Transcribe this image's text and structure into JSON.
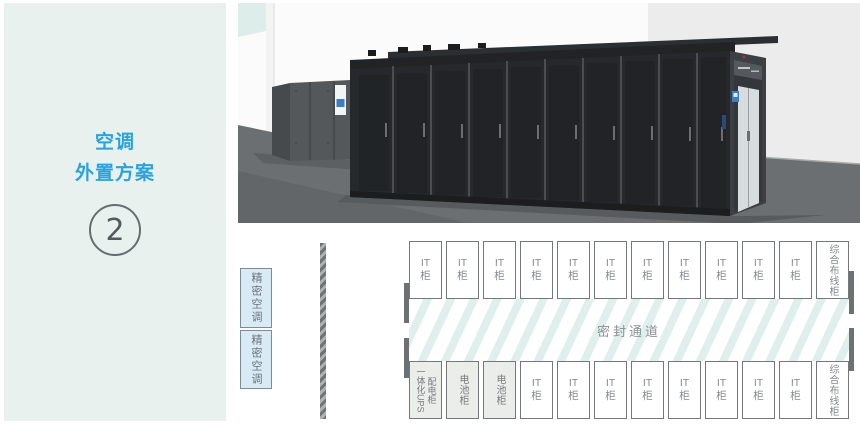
{
  "sidebar": {
    "title_line1": "空调",
    "title_line2": "外置方案",
    "step_number": "2"
  },
  "diagram": {
    "precision_ac": [
      "精密空调",
      "精密空调"
    ],
    "aisle_label": "密封通道",
    "top_row": [
      "IT\n柜",
      "IT\n柜",
      "IT\n柜",
      "IT\n柜",
      "IT\n柜",
      "IT\n柜",
      "IT\n柜",
      "IT\n柜",
      "IT\n柜",
      "IT\n柜",
      "IT\n柜",
      "综合布线柜"
    ],
    "bottom_row_first": [
      "一体化UPS",
      "配电柜"
    ],
    "bottom_row": [
      "电池柜",
      "电池柜",
      "IT\n柜",
      "IT\n柜",
      "IT\n柜",
      "IT\n柜",
      "IT\n柜",
      "IT\n柜",
      "IT\n柜",
      "IT\n柜",
      "综合布线柜"
    ]
  },
  "colors": {
    "accent_blue": "#29a3dd",
    "sidebar_bg": "#e9f1ef",
    "precision_ac_fill": "#d8eaf6",
    "gray_cell_fill": "#ebedeb",
    "cell_border": "#74787b",
    "aisle_stripe": "#dff0ec",
    "wall_bar": "#6d7174",
    "label_gray": "#85898c"
  }
}
